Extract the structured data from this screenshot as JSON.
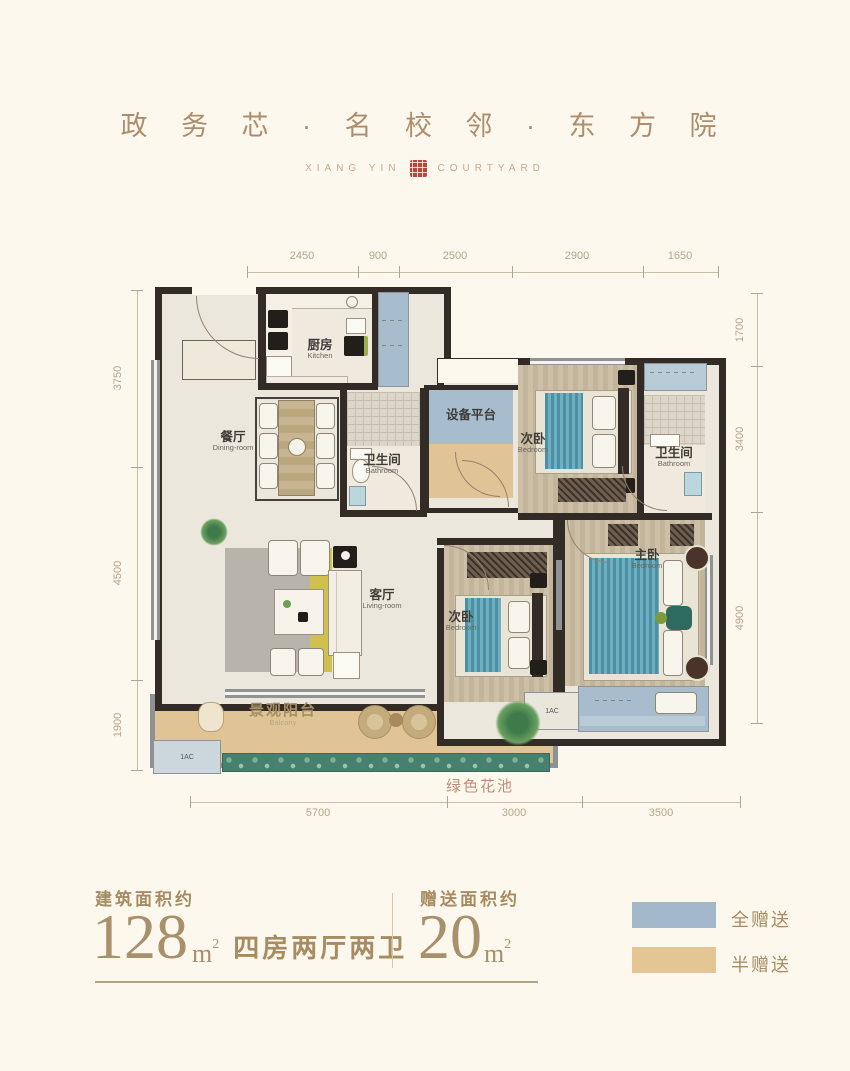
{
  "header": {
    "title": "政 务 芯 · 名 校 邻 · 东 方 院",
    "subtitle_left": "XIANG YIN",
    "subtitle_right": "COURTYARD"
  },
  "plan": {
    "dims_top": [
      "2450",
      "900",
      "2500",
      "2900",
      "1650"
    ],
    "dims_left": [
      "3750",
      "4500",
      "1900"
    ],
    "dims_right": [
      "1700",
      "3400",
      "4900"
    ],
    "dims_bottom": [
      "5700",
      "3000",
      "3500"
    ],
    "rooms": {
      "kitchen": {
        "zh": "厨房",
        "en": "Kitchen"
      },
      "dining": {
        "zh": "餐厅",
        "en": "Dining-room"
      },
      "bath1": {
        "zh": "卫生间",
        "en": "Bathroom"
      },
      "equipment": {
        "zh": "设备平台"
      },
      "bedroom2": {
        "zh": "次卧",
        "en": "Bedroom"
      },
      "bath2": {
        "zh": "卫生间",
        "en": "Bathroom"
      },
      "living": {
        "zh": "客厅",
        "en": "Living-room"
      },
      "bedroom3": {
        "zh": "次卧",
        "en": "Bedroom"
      },
      "master": {
        "zh": "主卧",
        "en": "Bedroom"
      },
      "balcony": {
        "zh": "景观阳台",
        "en": "Balcony"
      }
    },
    "green_bed_label": "绿色花池",
    "ac_label": "1AC"
  },
  "info": {
    "left_caption": "建筑面积约",
    "left_value": "128",
    "left_unit": "m",
    "left_sup": "2",
    "left_desc": "四房两厅两卫",
    "right_caption": "赠送面积约",
    "right_value": "20",
    "right_unit": "m",
    "right_sup": "2"
  },
  "legend": {
    "full": {
      "label": "全赠送",
      "color": "#a3b9cb"
    },
    "half": {
      "label": "半赠送",
      "color": "#e3c694"
    }
  },
  "colors": {
    "background": "#fdf8ee",
    "seal_red": "#b5473c",
    "accent_text": "#a8906a",
    "wall_dark": "#332b25",
    "bed_teal": "#4d90a5",
    "green_bed": "#47806e"
  }
}
